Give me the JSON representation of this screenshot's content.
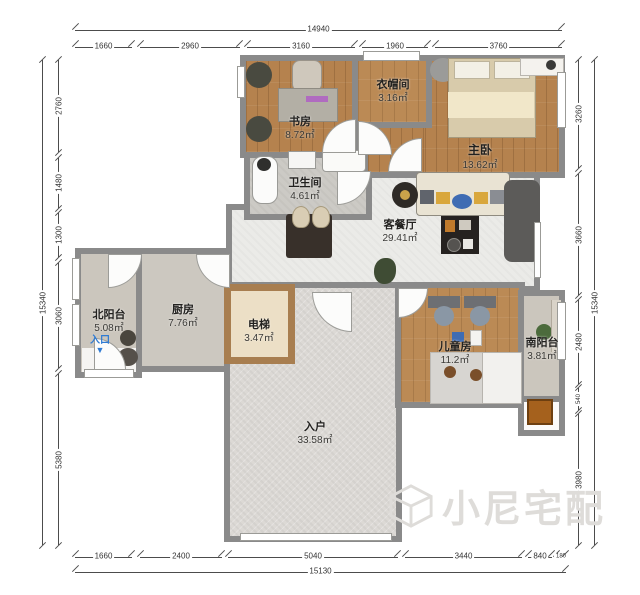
{
  "page": {
    "background": "#ffffff"
  },
  "watermark": {
    "text": "小尼宅配",
    "logo": "cube-logo"
  },
  "entrance": {
    "label": "入口",
    "arrow": "▼"
  },
  "dims": {
    "top": {
      "total": "14940",
      "segments": [
        "1660",
        "2960",
        "3160",
        "1960",
        "3760"
      ]
    },
    "bottom": {
      "total": "15130",
      "segments": [
        "1660",
        "2400",
        "5040",
        "3440",
        "840",
        "180"
      ]
    },
    "left": {
      "total": "15340",
      "segments": [
        "2760",
        "1480",
        "1300",
        "3060",
        "5380"
      ]
    },
    "right": {
      "total": "15340",
      "segments": [
        "3260",
        "3660",
        "2480",
        "540",
        "3980"
      ]
    }
  },
  "rooms": [
    {
      "name": "书房",
      "area": "8.72㎡"
    },
    {
      "name": "衣帽间",
      "area": "3.16㎡"
    },
    {
      "name": "主卧",
      "area": "13.62㎡"
    },
    {
      "name": "卫生间",
      "area": "4.61㎡"
    },
    {
      "name": "客餐厅",
      "area": "29.41㎡"
    },
    {
      "name": "北阳台",
      "area": "5.08㎡"
    },
    {
      "name": "厨房",
      "area": "7.76㎡"
    },
    {
      "name": "电梯",
      "area": "3.47㎡"
    },
    {
      "name": "入户",
      "area": "33.58㎡"
    },
    {
      "name": "儿童房",
      "area": "11.2㎡"
    },
    {
      "name": "南阳台",
      "area": "3.81㎡"
    }
  ],
  "colors": {
    "wall": "#8a8a8a",
    "wood_floor": "#b5824e",
    "living_tile": "#ebebe8",
    "entry_tile": "#dcd9d5",
    "balcony_floor": "#cbc6bd",
    "entrance_blue": "#2f7bd3",
    "watermark_gray": "#dedcd9"
  }
}
